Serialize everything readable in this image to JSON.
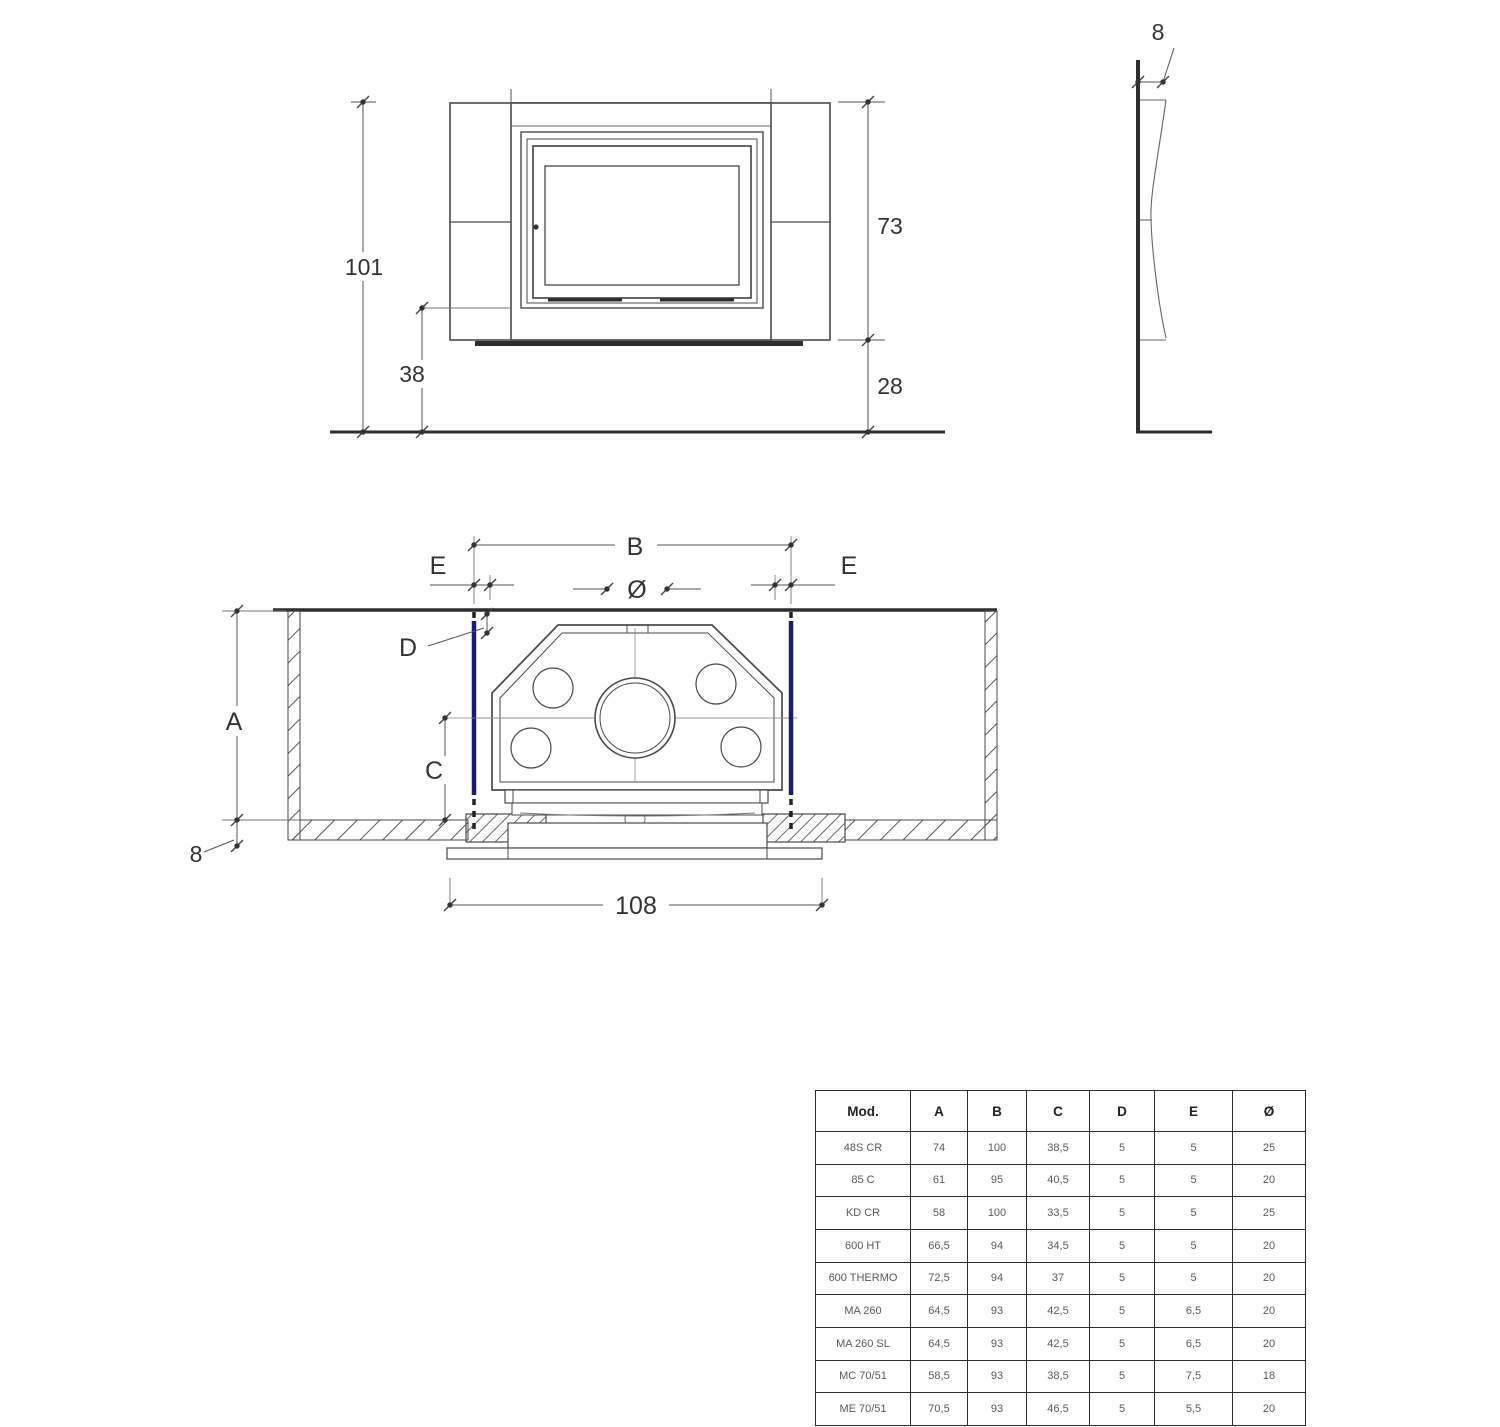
{
  "title": "Fireplace insert installation dimensions drawing",
  "colors": {
    "accent_blue": "#1b1b70",
    "line_dark": "#2e2e2e",
    "line_mid": "#4a4a4a",
    "dim_line": "#555555"
  },
  "front_view": {
    "height_total": "101",
    "firebox_height": "73",
    "base_height": "28",
    "lower_height": "38"
  },
  "side_view": {
    "panel_depth": "8"
  },
  "plan_view": {
    "span_label": "B",
    "edge_left_label": "E",
    "edge_right_label": "E",
    "flue_label": "Ø",
    "wall_offset_label": "D",
    "niche_depth_label": "A",
    "center_depth_label": "C",
    "wall_thickness": "8",
    "overall_width": "108"
  },
  "table": {
    "headers": [
      "Mod.",
      "A",
      "B",
      "C",
      "D",
      "E",
      "Ø"
    ],
    "rows": [
      [
        "48S CR",
        "74",
        "100",
        "38,5",
        "5",
        "5",
        "25"
      ],
      [
        "85 C",
        "61",
        "95",
        "40,5",
        "5",
        "5",
        "20"
      ],
      [
        "KD CR",
        "58",
        "100",
        "33,5",
        "5",
        "5",
        "25"
      ],
      [
        "600 HT",
        "66,5",
        "94",
        "34,5",
        "5",
        "5",
        "20"
      ],
      [
        "600 THERMO",
        "72,5",
        "94",
        "37",
        "5",
        "5",
        "20"
      ],
      [
        "MA 260",
        "64,5",
        "93",
        "42,5",
        "5",
        "6,5",
        "20"
      ],
      [
        "MA 260 SL",
        "64,5",
        "93",
        "42,5",
        "5",
        "6,5",
        "20"
      ],
      [
        "MC 70/51",
        "58,5",
        "93",
        "38,5",
        "5",
        "7,5",
        "18"
      ],
      [
        "ME 70/51",
        "70,5",
        "93",
        "46,5",
        "5",
        "5,5",
        "20"
      ]
    ]
  }
}
